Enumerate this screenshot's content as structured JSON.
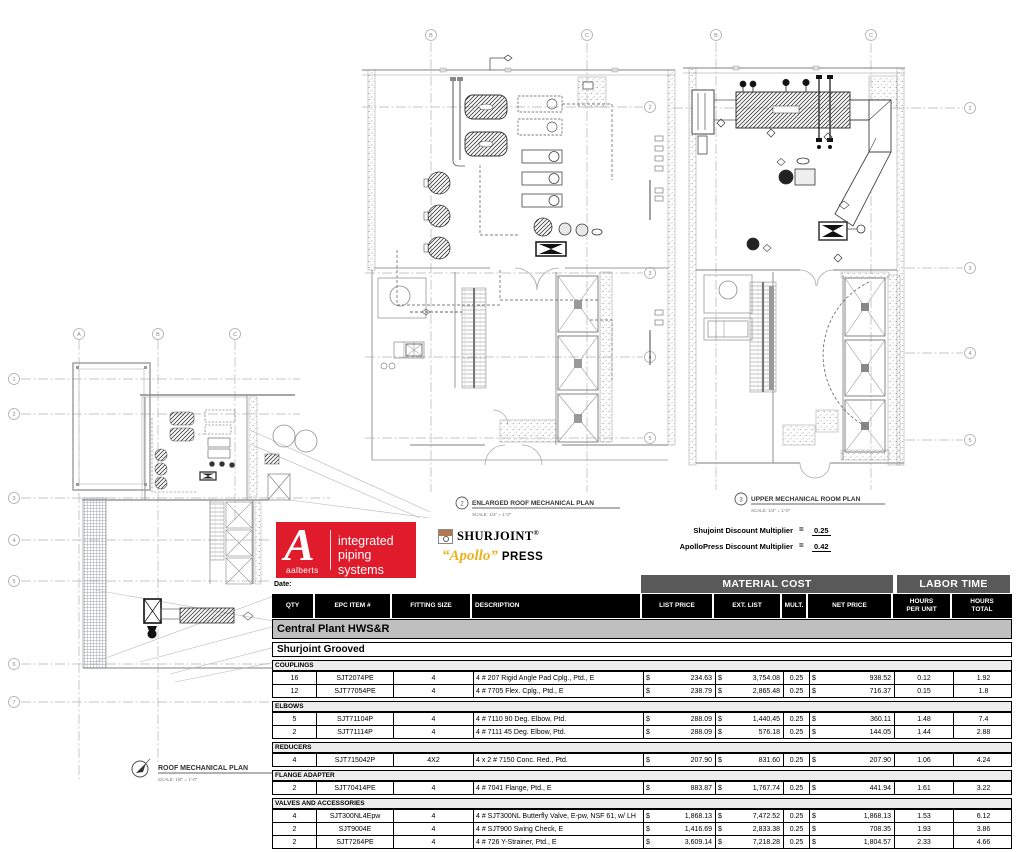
{
  "drawings": {
    "plan1": {
      "title": "ROOF MECHANICAL PLAN",
      "scale": "SCALE:  1/8\" = 1'-0\"",
      "grid_cols": [
        "A",
        "B",
        "C"
      ],
      "grid_rows": [
        "1",
        "2",
        "3",
        "4",
        "5",
        "6",
        "7"
      ]
    },
    "plan2": {
      "number": "2",
      "title": "ENLARGED ROOF MECHANICAL PLAN",
      "scale": "SCALE:  1/4\" = 1'-0\"",
      "grid_cols": [
        "B",
        "C"
      ],
      "grid_rows": [
        "2",
        "3",
        "4",
        "5"
      ]
    },
    "plan3": {
      "number": "3",
      "title": "UPPER MECHANICAL ROOM PLAN",
      "scale": "SCALE:  1/4\" = 1'-0\"",
      "grid_cols": [
        "B",
        "C"
      ],
      "grid_rows": [
        "2",
        "3",
        "4",
        "5"
      ]
    }
  },
  "logos": {
    "aalberts": {
      "mark": "A",
      "brand": "aalberts",
      "tagline_line1": "integrated",
      "tagline_line2": "piping systems",
      "color": "#e01b2c"
    },
    "shurjoint": {
      "name": "SHURJOINT",
      "reg": "®"
    },
    "apollo": {
      "script": "“Apollo”",
      "press": "PRESS",
      "color": "#ecb220"
    }
  },
  "multipliers": {
    "line1_label": "Shujoint Discount Multiplier",
    "line1_eq": "=",
    "line1_value": "0.25",
    "line2_label": "ApolloPress Discount Multiplier",
    "line2_eq": "=",
    "line2_value": "0.42"
  },
  "table": {
    "date_label": "Date:",
    "group_headers": {
      "material": "MATERIAL COST",
      "labor": "LABOR TIME"
    },
    "currency": "$",
    "columns": [
      {
        "key": "qty",
        "label": "QTY"
      },
      {
        "key": "epc",
        "label": "EPC ITEM #"
      },
      {
        "key": "size",
        "label": "FITTING SIZE"
      },
      {
        "key": "desc",
        "label": "DESCRIPTION"
      },
      {
        "key": "list",
        "label": "LIST PRICE"
      },
      {
        "key": "ext",
        "label": "EXT. LIST"
      },
      {
        "key": "mult",
        "label": "MULT."
      },
      {
        "key": "net",
        "label": "NET PRICE"
      },
      {
        "key": "hpu",
        "label": "HOURS",
        "label2": "PER UNIT"
      },
      {
        "key": "ht",
        "label": "HOURS",
        "label2": "TOTAL"
      }
    ],
    "title_row": "Central Plant HWS&R",
    "subtitle_row": "Shurjoint Grooved",
    "sections": [
      {
        "category": "COUPLINGS",
        "rows": [
          {
            "qty": "16",
            "epc": "SJT2074PE",
            "size": "4",
            "desc": "4 # 207 Rigid Angle Pad Cplg., Ptd., E",
            "list": "234.63",
            "ext": "3,754.08",
            "mult": "0.25",
            "net": "938.52",
            "hpu": "0.12",
            "ht": "1.92"
          },
          {
            "qty": "12",
            "epc": "SJT77054PE",
            "size": "4",
            "desc": "4 # 7705 Flex. Cplg., Ptd., E",
            "list": "238.79",
            "ext": "2,865.48",
            "mult": "0.25",
            "net": "716.37",
            "hpu": "0.15",
            "ht": "1.8"
          }
        ]
      },
      {
        "category": "ELBOWS",
        "rows": [
          {
            "qty": "5",
            "epc": "SJT71104P",
            "size": "4",
            "desc": "4 # 7110 90 Deg. Elbow, Ptd.",
            "list": "288.09",
            "ext": "1,440.45",
            "mult": "0.25",
            "net": "360.11",
            "hpu": "1.48",
            "ht": "7.4"
          },
          {
            "qty": "2",
            "epc": "SJT71114P",
            "size": "4",
            "desc": "4 # 7111 45 Deg. Elbow, Ptd.",
            "list": "288.09",
            "ext": "576.18",
            "mult": "0.25",
            "net": "144.05",
            "hpu": "1.44",
            "ht": "2.88"
          }
        ]
      },
      {
        "category": "REDUCERS",
        "rows": [
          {
            "qty": "4",
            "epc": "SJT715042P",
            "size": "4X2",
            "desc": "4 x 2 # 7150 Conc. Red., Ptd.",
            "list": "207.90",
            "ext": "831.60",
            "mult": "0.25",
            "net": "207.90",
            "hpu": "1.06",
            "ht": "4.24"
          }
        ]
      },
      {
        "category": "FLANGE ADAPTER",
        "rows": [
          {
            "qty": "2",
            "epc": "SJT70414PE",
            "size": "4",
            "desc": "4 # 7041 Flange, Ptd., E",
            "list": "883.87",
            "ext": "1,767.74",
            "mult": "0.25",
            "net": "441.94",
            "hpu": "1.61",
            "ht": "3.22"
          }
        ]
      },
      {
        "category": "VALVES AND ACCESSORIES",
        "rows": [
          {
            "qty": "4",
            "epc": "SJT300NL4Epw",
            "size": "4",
            "desc": "4 # SJT300NL Butterfly Valve, E-pw, NSF 61, w/ LH",
            "list": "1,868.13",
            "ext": "7,472.52",
            "mult": "0.25",
            "net": "1,868.13",
            "hpu": "1.53",
            "ht": "6.12"
          },
          {
            "qty": "2",
            "epc": "SJT9004E",
            "size": "4",
            "desc": "4 # SJT900 Swing Check, E",
            "list": "1,416.69",
            "ext": "2,833.38",
            "mult": "0.25",
            "net": "708.35",
            "hpu": "1.93",
            "ht": "3.86"
          },
          {
            "qty": "2",
            "epc": "SJT7264PE",
            "size": "4",
            "desc": "4 # 726 Y-Strainer, Ptd., E",
            "list": "3,609.14",
            "ext": "7,218.28",
            "mult": "0.25",
            "net": "1,804.57",
            "hpu": "2.33",
            "ht": "4.66"
          }
        ]
      }
    ]
  }
}
